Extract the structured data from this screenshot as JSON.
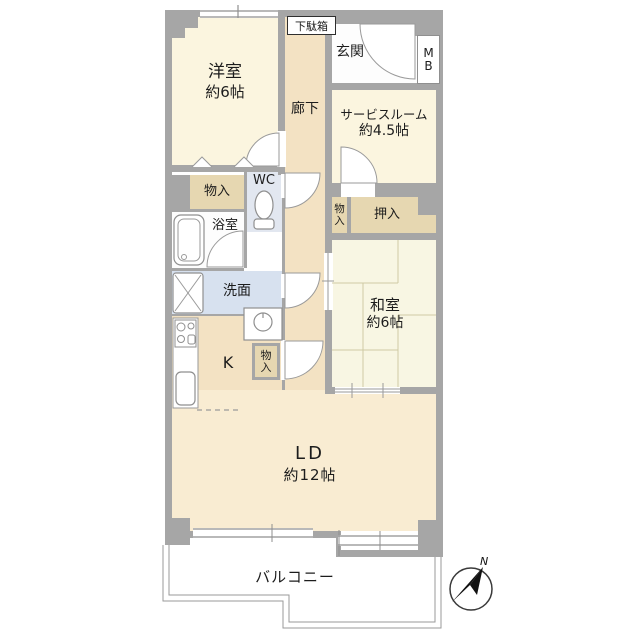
{
  "plan": {
    "type": "floorplan",
    "unit_layout": "2LDK+S",
    "rooms": {
      "yoshitsu": {
        "name": "洋室",
        "size": "約6帖"
      },
      "rouka": {
        "name": "廊下"
      },
      "getabako": {
        "name": "下駄箱"
      },
      "genkan": {
        "name": "玄関"
      },
      "mb": {
        "name": "MB"
      },
      "service_room": {
        "name": "サービスルーム",
        "size": "約4.5帖"
      },
      "monoiri_hall": {
        "name": "物入"
      },
      "wc": {
        "name": "WC"
      },
      "yokushitsu": {
        "name": "浴室"
      },
      "senmen": {
        "name": "洗面"
      },
      "monoiri_washitsu": {
        "name": "物入"
      },
      "oshiire": {
        "name": "押入"
      },
      "washitsu": {
        "name": "和室",
        "size": "約6帖"
      },
      "kitchen": {
        "name": "K"
      },
      "monoiri_kitchen": {
        "name": "物入"
      },
      "ld": {
        "name": "LD",
        "size": "約12帖"
      },
      "balcony": {
        "name": "バルコニー"
      }
    },
    "compass": {
      "north_label": "N",
      "direction": "north-east"
    },
    "colors": {
      "wall": "#a6a6a6",
      "western_room_floor": "#fbf5df",
      "tatami_floor": "#f8f6e3",
      "ld_floor": "#f9ecd2",
      "corridor_floor": "#f3e2c3",
      "closet_floor": "#e6d7b1",
      "wc_floor": "#e2e7f0",
      "senmen_floor": "#d7e1ef",
      "line": "#999999"
    }
  }
}
